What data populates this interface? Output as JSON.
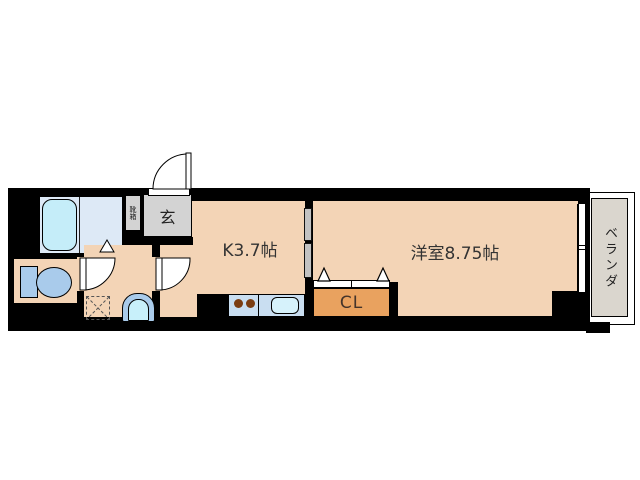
{
  "rooms": {
    "kitchen": {
      "label": "K3.7帖"
    },
    "western_room": {
      "label": "洋室8.75帖"
    },
    "closet": {
      "label": "CL"
    },
    "entrance": {
      "label": "玄"
    },
    "shoe_cabinet": {
      "label": "靴箱"
    },
    "balcony": {
      "label": "ベランダ"
    }
  },
  "fixtures": [
    "bathtub",
    "toilet",
    "wash-basin",
    "washing-machine-space",
    "kitchen-counter",
    "stove-burners",
    "kitchen-sink",
    "entrance-door",
    "bathroom-door",
    "toilet-door",
    "kitchen-door",
    "sliding-partition",
    "closet-folding-doors",
    "sliding-window"
  ],
  "colors": {
    "wall": "#000000",
    "floor": "#f3d4b6",
    "closet_fill": "#e9a25f",
    "bathroom_floor": "#dde9f6",
    "bathtub_fill": "#c5edf9",
    "fixture_blue": "#a9cbeb",
    "counter_fill": "#c9def1",
    "entrance_gray": "#d3d3d3",
    "balcony_gray": "#dad6ce",
    "burner_brown": "#7b3d12"
  }
}
